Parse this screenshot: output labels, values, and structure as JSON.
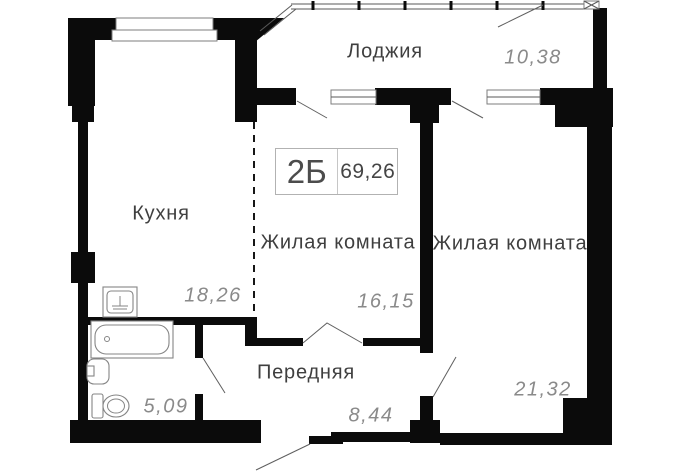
{
  "unit_card": {
    "type": "2Б",
    "total_area": "69,26"
  },
  "rooms": {
    "loggia": {
      "name": "Лоджия",
      "area": "10,38"
    },
    "kitchen": {
      "name": "Кухня",
      "area": "18,26"
    },
    "living1": {
      "name": "Жилая комната",
      "area": "16,15"
    },
    "living2": {
      "name": "Жилая комната",
      "area": "21,32"
    },
    "hall": {
      "name": "Передняя",
      "area": "8,44"
    },
    "bathroom": {
      "area": "5,09"
    }
  },
  "colors": {
    "wall": "#0b0b0b",
    "room_label": "#3f3f3f",
    "area_value": "#8a8a8a",
    "background": "#ffffff"
  }
}
